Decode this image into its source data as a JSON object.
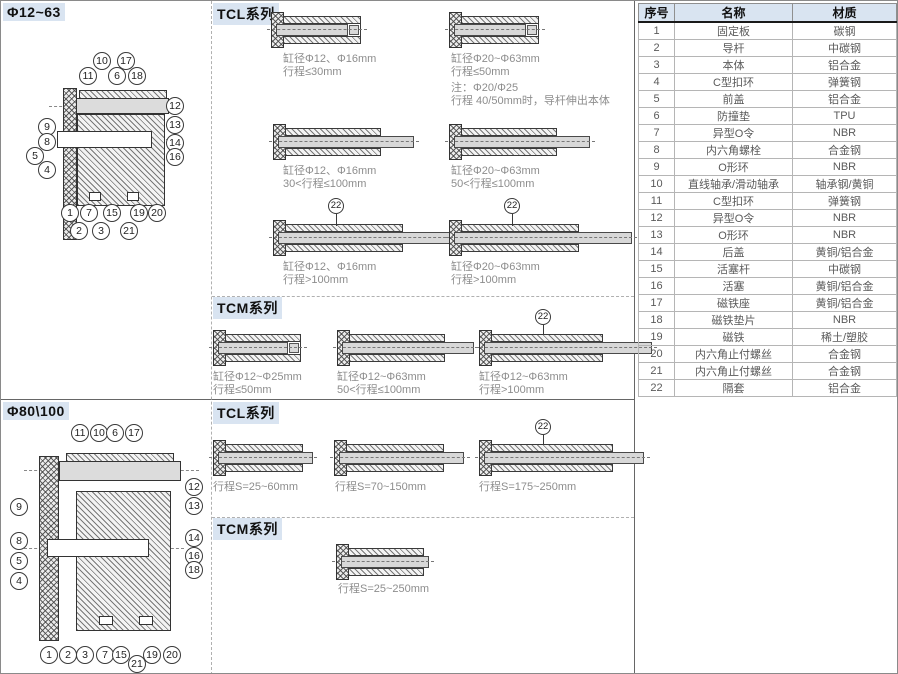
{
  "sections": {
    "top_left_title": "Φ12~63",
    "bottom_left_title": "Φ80\\100",
    "tcl_label_top": "TCL系列",
    "tcm_label_top": "TCM系列",
    "tcl_label_bottom": "TCL系列",
    "tcm_label_bottom": "TCM系列"
  },
  "colors": {
    "label_bg": "#d9e4f1",
    "caption_gray": "#8d8d8d",
    "rod_fill": "#d8d8d8"
  },
  "d1": {
    "callouts": [
      "10",
      "17",
      "11",
      "6",
      "18",
      "12",
      "13",
      "14",
      "16",
      "9",
      "8",
      "5",
      "4",
      "1",
      "7",
      "15",
      "19",
      "20",
      "2",
      "3",
      "21"
    ]
  },
  "d2": {
    "callouts": [
      "11",
      "10",
      "6",
      "17",
      "12",
      "13",
      "14",
      "16",
      "18",
      "9",
      "8",
      "5",
      "4",
      "1",
      "2",
      "3",
      "7",
      "15",
      "19",
      "20",
      "21"
    ]
  },
  "mid_top": {
    "tcl_items": [
      {
        "caption1": "缸径Φ12、Φ16mm",
        "caption2": "行程≤30mm"
      },
      {
        "caption1": "缸径Φ20~Φ63mm",
        "caption2": "行程≤50mm",
        "note1": "注：Φ20/Φ25",
        "note2": "行程 40/50mm时，导杆伸出本体"
      },
      {
        "caption1": "缸径Φ12、Φ16mm",
        "caption2": "30<行程≤100mm"
      },
      {
        "caption1": "缸径Φ20~Φ63mm",
        "caption2": "50<行程≤100mm"
      },
      {
        "caption1": "缸径Φ12、Φ16mm",
        "caption2": "行程>100mm",
        "callout": "22"
      },
      {
        "caption1": "缸径Φ20~Φ63mm",
        "caption2": "行程>100mm",
        "callout": "22"
      }
    ],
    "tcm_items": [
      {
        "caption1": "缸径Φ12~Φ25mm",
        "caption2": "行程≤50mm"
      },
      {
        "caption1": "缸径Φ12~Φ63mm",
        "caption2": "50<行程≤100mm"
      },
      {
        "caption1": "缸径Φ12~Φ63mm",
        "caption2": "行程>100mm",
        "callout": "22"
      }
    ]
  },
  "mid_bottom": {
    "tcl_items": [
      {
        "caption1": "行程S=25~60mm"
      },
      {
        "caption1": "行程S=70~150mm"
      },
      {
        "caption1": "行程S=175~250mm",
        "callout": "22"
      }
    ],
    "tcm_items": [
      {
        "caption1": "行程S=25~250mm"
      }
    ]
  },
  "table": {
    "headers": [
      "序号",
      "名称",
      "材质"
    ],
    "rows": [
      [
        "1",
        "固定板",
        "碳钢"
      ],
      [
        "2",
        "导杆",
        "中碳钢"
      ],
      [
        "3",
        "本体",
        "铝合金"
      ],
      [
        "4",
        "C型扣环",
        "弹簧钢"
      ],
      [
        "5",
        "前盖",
        "铝合金"
      ],
      [
        "6",
        "防撞垫",
        "TPU"
      ],
      [
        "7",
        "异型O令",
        "NBR"
      ],
      [
        "8",
        "内六角螺栓",
        "合金钢"
      ],
      [
        "9",
        "O形环",
        "NBR"
      ],
      [
        "10",
        "直线轴承/滑动轴承",
        "轴承钢/黄铜"
      ],
      [
        "11",
        "C型扣环",
        "弹簧钢"
      ],
      [
        "12",
        "异型O令",
        "NBR"
      ],
      [
        "13",
        "O形环",
        "NBR"
      ],
      [
        "14",
        "后盖",
        "黄铜/铝合金"
      ],
      [
        "15",
        "活塞杆",
        "中碳钢"
      ],
      [
        "16",
        "活塞",
        "黄铜/铝合金"
      ],
      [
        "17",
        "磁铁座",
        "黄铜/铝合金"
      ],
      [
        "18",
        "磁铁垫片",
        "NBR"
      ],
      [
        "19",
        "磁铁",
        "稀土/塑胶"
      ],
      [
        "20",
        "内六角止付螺丝",
        "合金钢"
      ],
      [
        "21",
        "内六角止付螺丝",
        "合金钢"
      ],
      [
        "22",
        "隔套",
        "铝合金"
      ]
    ]
  }
}
